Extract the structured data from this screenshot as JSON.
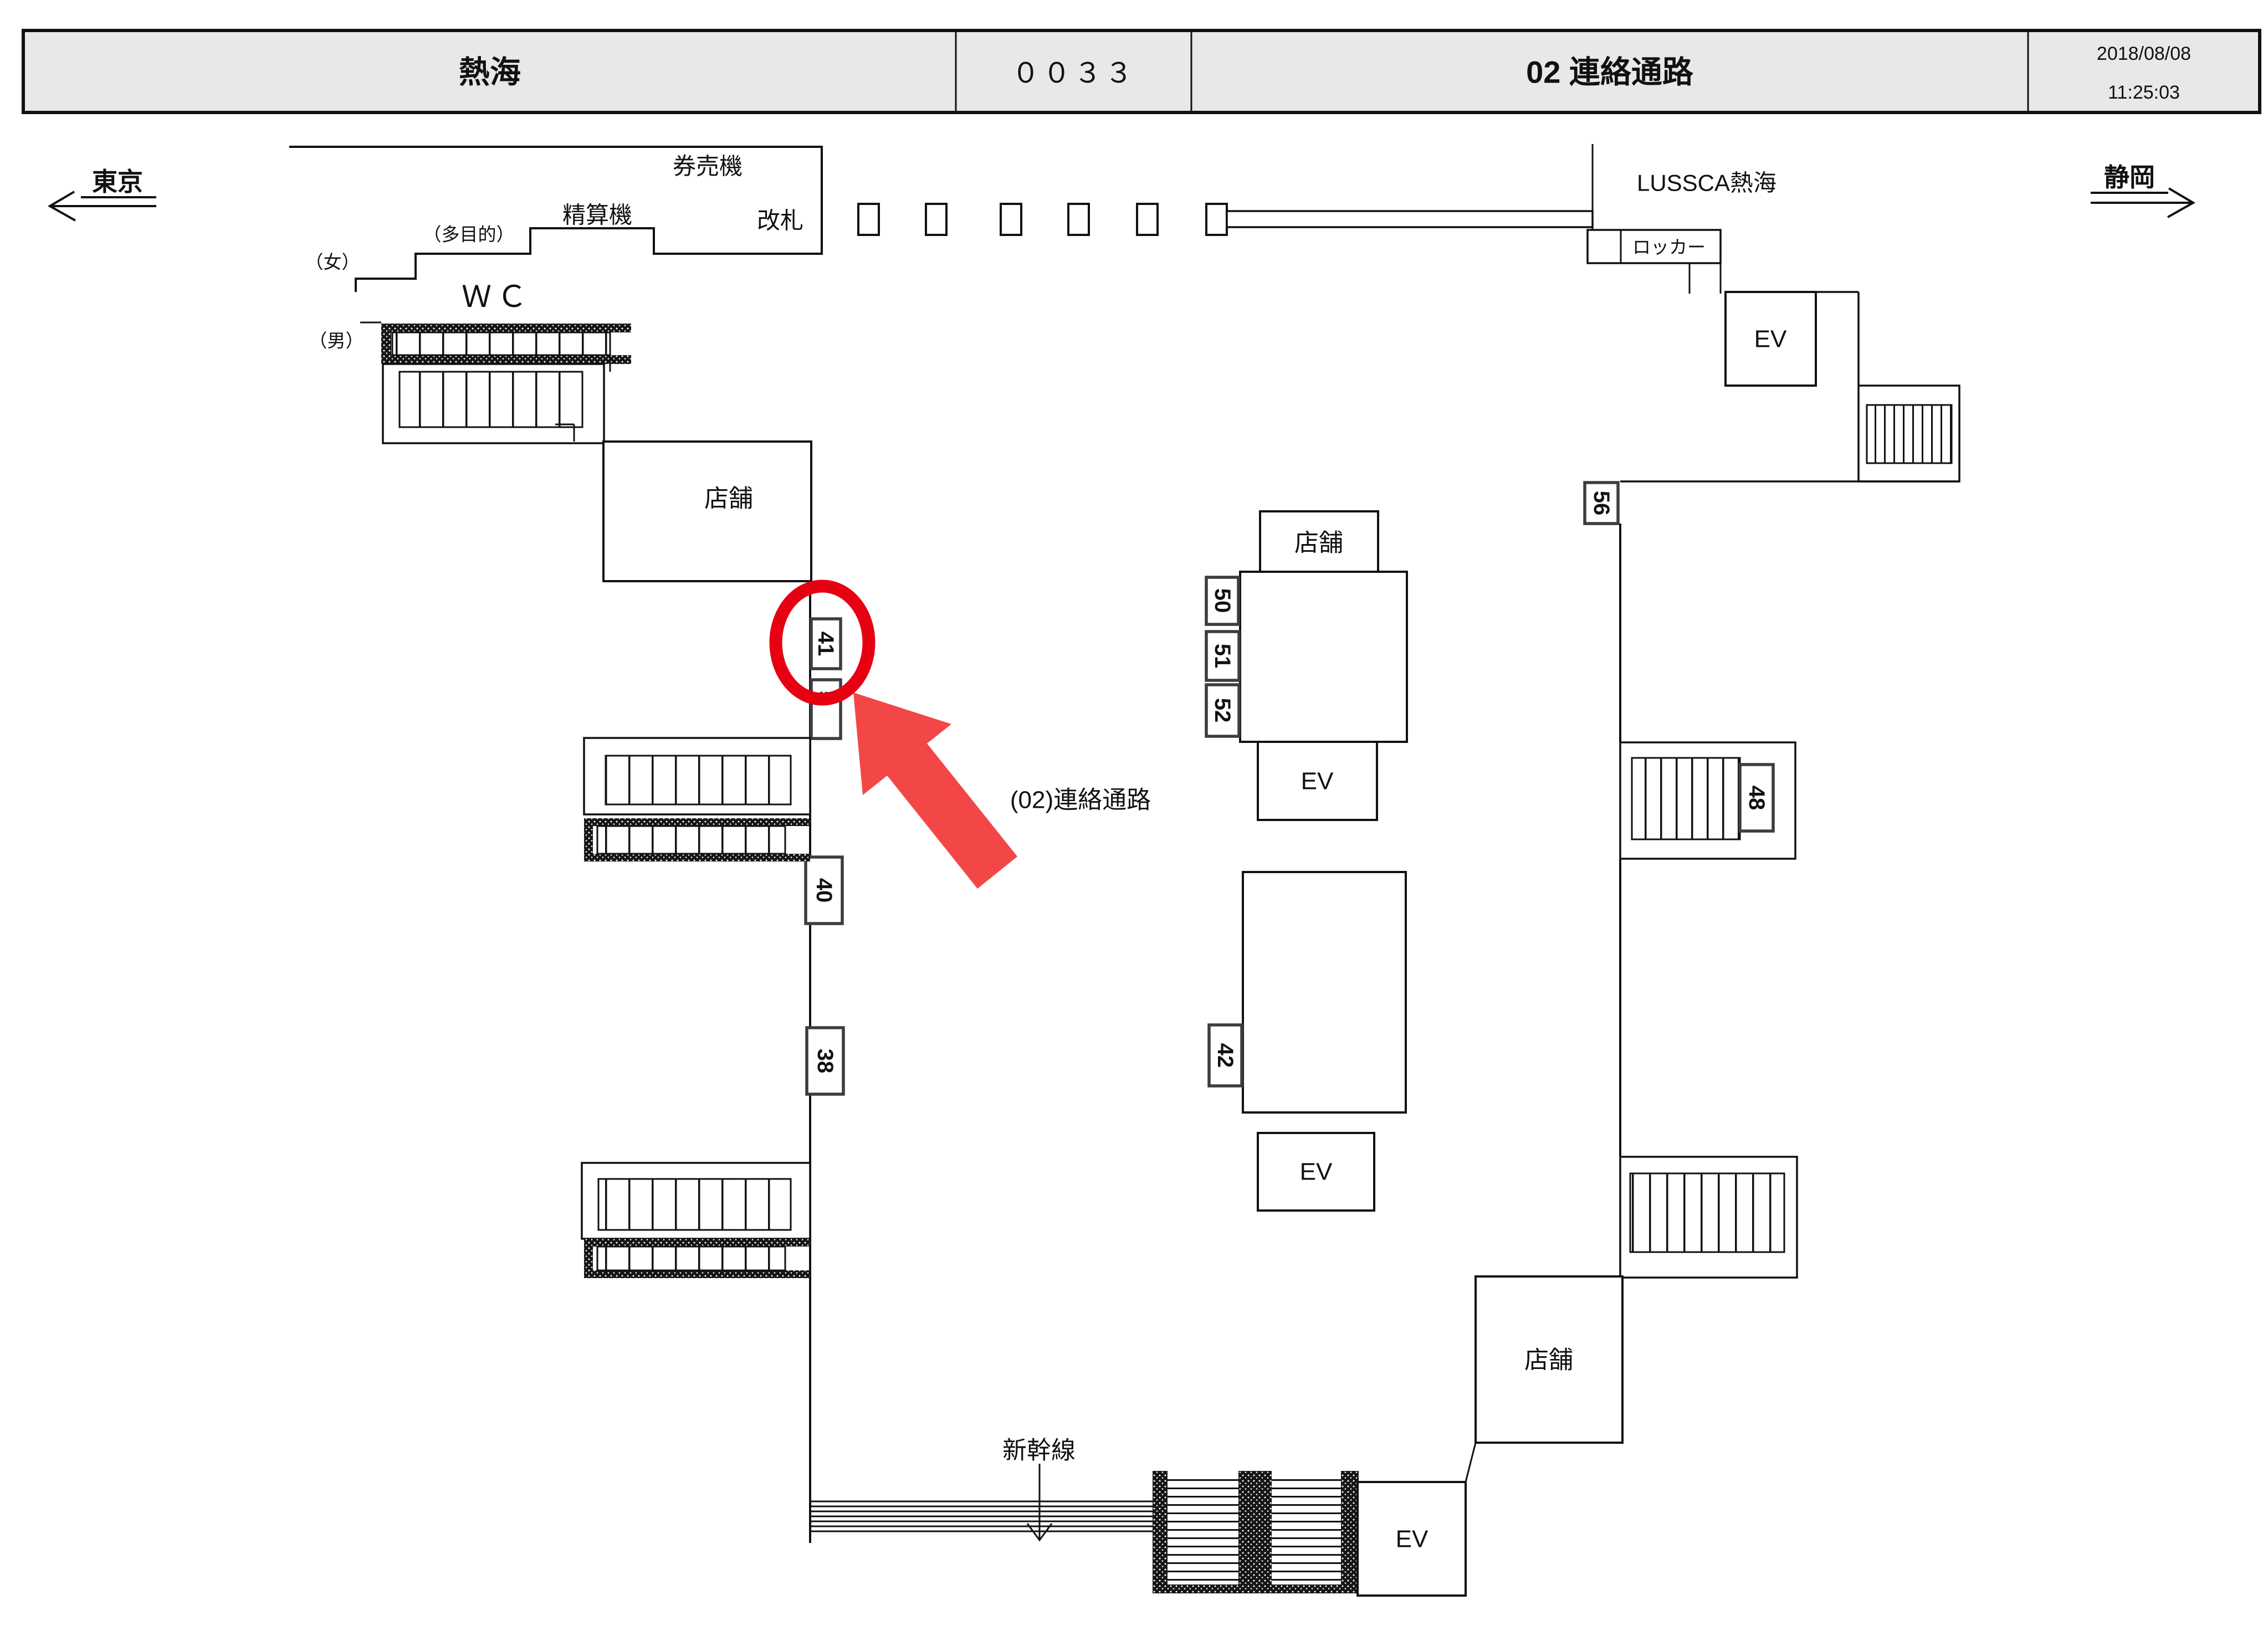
{
  "header": {
    "station_name": "熱海",
    "page_code": "００３３",
    "floor_title": "02 連絡通路",
    "date": "2018/08/08",
    "time": "11:25:03"
  },
  "directions": {
    "west": "東京",
    "east": "静岡"
  },
  "labels": {
    "ticket_machines": "券売機",
    "fare_adjustment": "精算機",
    "ticket_gate": "改札",
    "multipurpose": "（多目的）",
    "women": "（女）",
    "toilet": "ＷＣ",
    "men": "（男）",
    "store": "店舗",
    "elevator": "EV",
    "lussca": "LUSSCA熱海",
    "locker": "ロッカー",
    "shinkansen": "新幹線",
    "passage": "(02)連絡通路"
  },
  "tags": {
    "t38": "38",
    "t40": "40",
    "t41": "41",
    "t42": "42",
    "t48": "48",
    "t50": "50",
    "t51": "51",
    "t52": "52",
    "t56": "56",
    "t5": "5"
  },
  "highlight": {
    "selected_tag": "41",
    "circle_color": "#e60012",
    "arrow_color": "#f34747"
  }
}
